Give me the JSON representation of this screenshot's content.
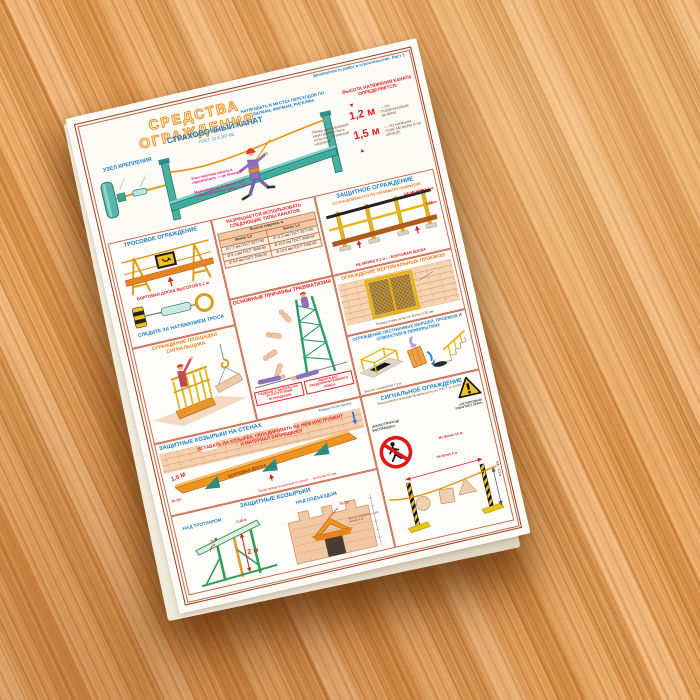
{
  "poster": {
    "meta_note": "Безопасность работ в строительстве. Лист 1",
    "title": "СРЕДСТВА ОГРАЖДЕНИЯ",
    "colors": {
      "title_orange": "#ef8c1e",
      "blue": "#1b7fc2",
      "red": "#e02020",
      "magenta": "#e0218a",
      "frame": "#9e3a1c",
      "teal": "#3fae9f",
      "yellow": "#e8b414"
    },
    "safety_rope": {
      "title": "СТРАХОВОЧНЫЙ КАНАТ",
      "gost": "ГОСТ 12.4.107-82",
      "unit_title": "УЗЕЛ КРЕПЛЕНИЯ",
      "note_top": "НАТЯГИВАТЬ В МЕСТАХ ПЕРЕХОДОВ ПО БАЛКАМ, ФЕРМАМ, РИГЕЛЯМ",
      "note_angle": "Угол наклона каната к горизонтали — не более 7°",
      "note_span": "Максимальный пролёт без промежуточных опор — 12 м",
      "note_test": "Перед эксплуатацией канат должен быть испытан статической нагрузкой",
      "height_heading": "ВЫСОТА НАТЯЖЕНИЯ КАНАТА ОПРЕДЕЛЯЕТСЯ:",
      "h1": "1,2 м",
      "d1": "— ПО ПОДКРАНОВЫМ БАЛКАМ",
      "h2": "1,5 м",
      "d2": "— ПО НИЖНИМ ПОЯСАМ ФЕРМ И НА КРОВЛЕ"
    },
    "rope_fence": {
      "title": "ТРОСОВОЕ ОГРАЖДЕНИЕ",
      "board": "БОРТОВАЯ ДОСКА ВЫСОТОЙ 0,1 м",
      "tension": "СЛЕДИТЕ ЗА НАТЯЖЕНИЕМ ТРОСА"
    },
    "rope_table": {
      "title": "РАЗРЕШАЕТСЯ ИСПОЛЬЗОВАТЬ СЛЕДУЮЩИЕ ТИПЫ КАНАТОВ",
      "header": "Высота падения, м",
      "columns": [
        "Менее 1,2",
        "Более 1,2"
      ],
      "rows": [
        [
          "Ø 7,7 мм ГОСТ 3077-80",
          "Ø 11,5 мм ГОСТ 3077-80"
        ],
        [
          "Ø 9,1 мм ГОСТ 3088-80",
          "Ø 13,0 мм ГОСТ 3088-80"
        ],
        [
          "Ø 9,6 мм ГОСТ 7668-80",
          "Ø 13,5 мм ГОСТ 7668-80"
        ]
      ]
    },
    "injury": {
      "title": "ОСНОВНЫЕ ПРИЧИНЫ ТРАВМАТИЗМА",
      "caption1": "ПАДЕНИЕ С ВЫСОТЫ ИЗ-ЗА ОТСУТСТВИЯ ОГРАЖДЕНИЯ",
      "caption2": "РАБОТА БЕЗ ПРЕДОХРАНИТЕЛЬНОГО ПОЯСА"
    },
    "protective_rail": {
      "title": "ЗАЩИТНОЕ ОГРАЖДЕНИЕ",
      "subtitle": "УСТАНАВЛИВАЕТСЯ ПО ПЕРИМЕТРУ ПОКРЫТИЯ",
      "dim_height": "НЕ МЕНЕЕ 1,1 м",
      "dim_mid": "0,45 м",
      "dim_board": "НЕ МЕНЕЕ 0,1 м — БОРТОВАЯ ДОСКА"
    },
    "vertical_openings": {
      "title": "ОГРАЖДЕНИЕ ВЕРТИКАЛЬНЫХ ПРОЕМОВ",
      "mesh_note": "Размер ячеек сетки не более 0,25 мм"
    },
    "stairs_openings": {
      "title": "ОГРАЖДЕНИЕ ЛЕСТНИЧНЫХ МАРШЕЙ, ПРОЕМОВ И ОТВЕРСТИЙ В ПЕРЕКРЫТИЯХ",
      "fence_note": "Высота ограждения 1,1 м"
    },
    "signal_platform": {
      "title": "ОГРАЖДЕНИЕ ПЛОЩАДКИ СИГНАЛЬЩИКА"
    },
    "wall_canopies": {
      "title": "ЗАЩИТНЫЕ КОЗЫРЬКИ НА СТЕНАХ",
      "warning": "ВСТАВАТЬ НА КОЗЫРЕК, СКЛАДИРОВАТЬ НА НЕМ ИНСТРУМЕНТ И МАТЕРИАЛ ЗАПРЕЩЕНО!",
      "width_dim": "1,5 М",
      "angle": "70-75°",
      "board": "БОРТОВАЯ ДОСКА",
      "gap_note": "Зазор между козырьком и стеной — не более 50 мм",
      "height_note": "Каждые 6 м по высоте"
    },
    "canopies": {
      "title": "ЗАЩИТНЫЕ КОЗЫРЬКИ",
      "left_label": "НАД ТРОТУАРОМ",
      "left_height": "2 м",
      "left_angle": "70°",
      "left_top": "0,18 м",
      "right_label": "НАД ПОДЪЕЗДОМ",
      "right_angle": "70-75°",
      "right_note": "Вынос козырька — не менее 2 м"
    },
    "signal_fence": {
      "title": "СИГНАЛЬНОЕ ОГРАЖДЕНИЕ",
      "subtitle": "Выполняется знаками безопасности по ГОСТ 12.4.026-76*",
      "sign_left": "«ВХОД (ПРОХОД) ВОСПРЕЩЕН»",
      "sign_right": "«ОСТОРОЖНО! РАБОТАЕТ КРАН»",
      "dim_span": "Не более 12 м",
      "dim_post": "Не более 6 м",
      "dim_height": "0,8 – 1,1 м"
    }
  }
}
